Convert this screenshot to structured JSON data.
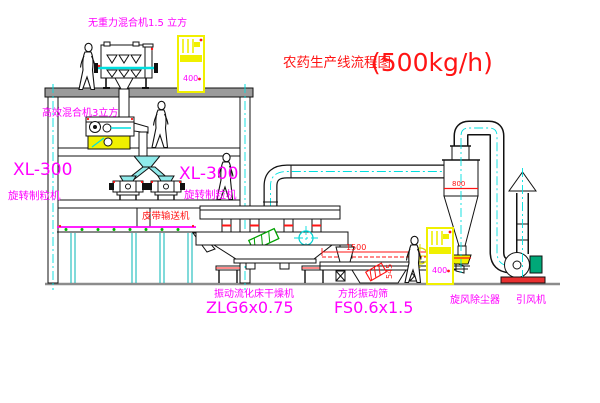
{
  "colors": {
    "background": "#ffffff",
    "line": "#111111",
    "centerline_cyan": "#00dfdf",
    "label_magenta": "#ff00ff",
    "label_red": "#ff1414",
    "cabinet_yellow": "#f0f000",
    "machine_green": "#00a878",
    "ground_gray": "#8c8c8c"
  },
  "title": {
    "text": "农药生产线流程图",
    "capacity": "(500kg/h)"
  },
  "equipment_labels": {
    "gravity_mixer": "无重力混合机1.5 立方",
    "high_eff_mixer": "高效混合机3立方",
    "granulator_left_model": "XL-300",
    "granulator_left_name": "旋转制粒机",
    "granulator_right_model": "XL-300",
    "granulator_right_name": "旋转制粒机",
    "belt_conveyor": "皮带输送机",
    "dryer_name": "振动流化床干燥机",
    "dryer_model": "ZLG6x0.75",
    "sieve_name": "方形振动筛",
    "sieve_model": "FS0.6x1.5",
    "cyclone_name": "旋风除尘器",
    "fan_name": "引风机"
  },
  "dimensions": {
    "cyclone_inlet": "800",
    "sieve_length": "1500",
    "sieve_height": "545"
  },
  "cabinets": {
    "top_display": "400",
    "bottom_display": "400"
  }
}
